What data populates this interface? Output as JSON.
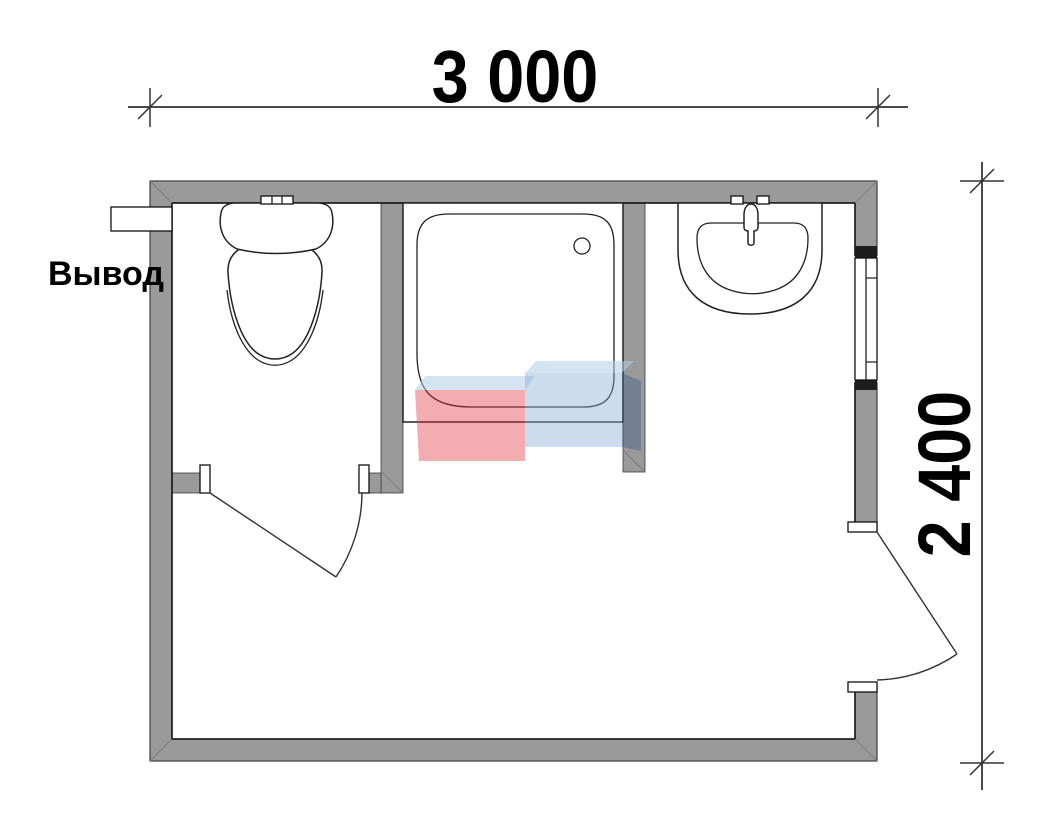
{
  "drawing": {
    "type": "bathroom-floor-plan",
    "dimensions": {
      "width_label": "3 000",
      "height_label": "2 400"
    },
    "labels": {
      "outlet": "Вывод"
    },
    "watermark": {
      "text": "VANDA",
      "red_block": "#e0323c",
      "blue_block": "#86acd2",
      "bevel": "#b1cde5",
      "dark_bevel": "#46648c",
      "text_color": "#ffffff"
    },
    "colors": {
      "wall_fill": "#9a9a9a",
      "wall_outline": "#3c3c3c",
      "room_line": "#111111",
      "dimension_line": "#4a4a4a",
      "background": "#ffffff"
    },
    "fixtures": [
      "toilet",
      "shower-tray",
      "washbasin",
      "window",
      "entrance-door",
      "toilet-door",
      "water-outlet"
    ]
  }
}
